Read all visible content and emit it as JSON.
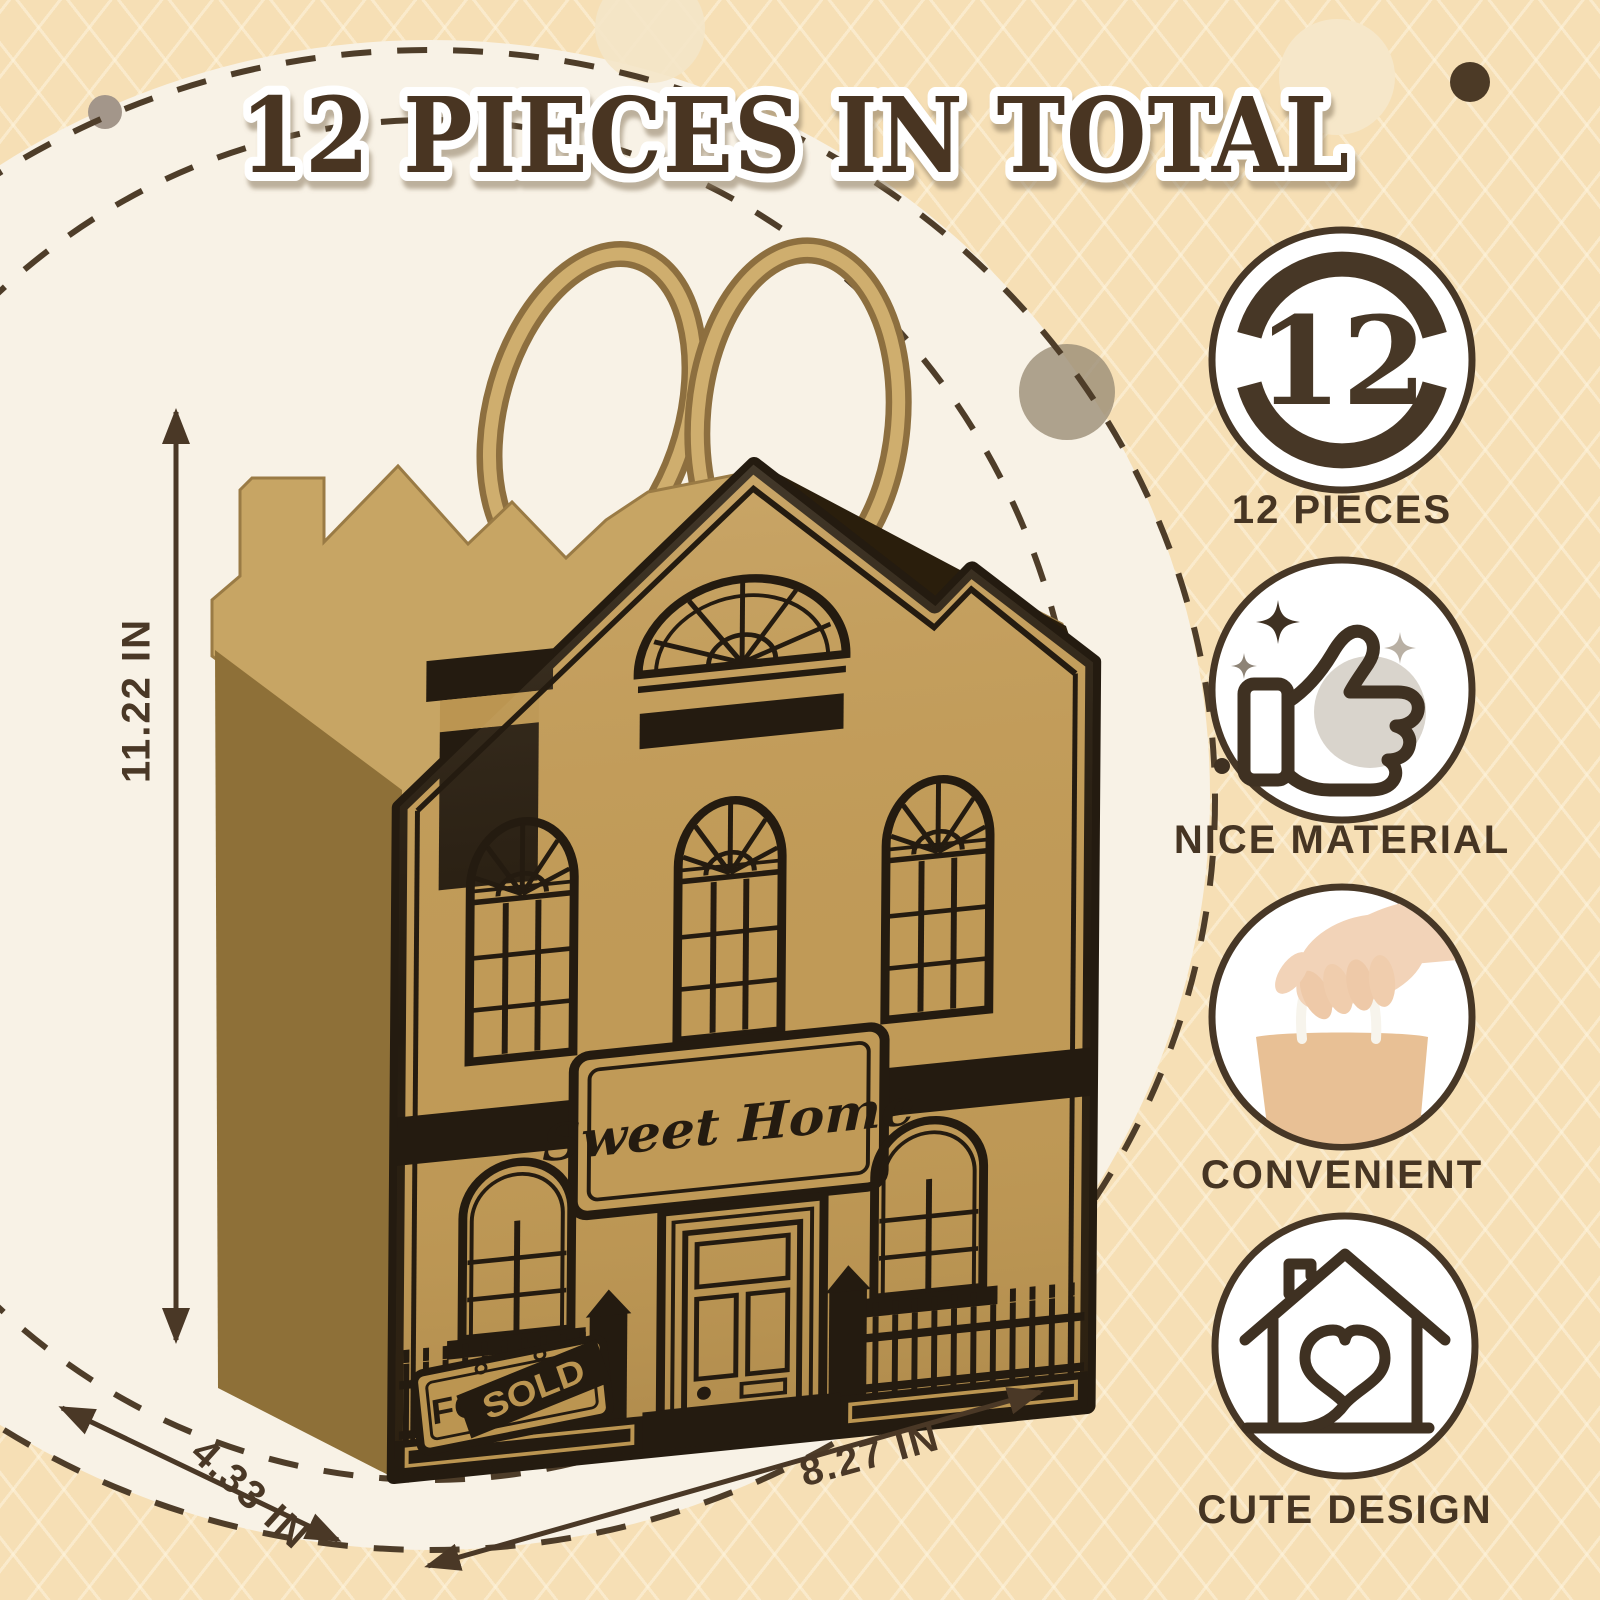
{
  "title": "12 PIECES IN TOTAL",
  "dimensions": {
    "height": "11.22 IN",
    "width": "8.27 IN",
    "depth": "4.33 IN"
  },
  "bag": {
    "plaque": "Sweet Home",
    "fence_sign": "FOR",
    "fence_sign_overlay": "SOLD"
  },
  "features": [
    {
      "icon": "count-12-badge-icon",
      "badge": "12",
      "label": "12 PIECES"
    },
    {
      "icon": "thumbs-up-sparkles-icon",
      "label": "NICE MATERIAL"
    },
    {
      "icon": "hand-holding-bag-photo",
      "label": "CONVENIENT"
    },
    {
      "icon": "house-heart-icon",
      "label": "CUTE DESIGN"
    }
  ],
  "colors": {
    "background": "#f6dfb5",
    "pattern_line": "#fdf2da",
    "spotlight_circle": "#f8f2e6",
    "accent_brown": "#4a3726",
    "print_black": "#241b10",
    "kraft": "#c09a57",
    "kraft_dark": "#8e7038",
    "kraft_light": "#c7a564",
    "handle": "#cfae6e",
    "label_text": "#463523"
  }
}
